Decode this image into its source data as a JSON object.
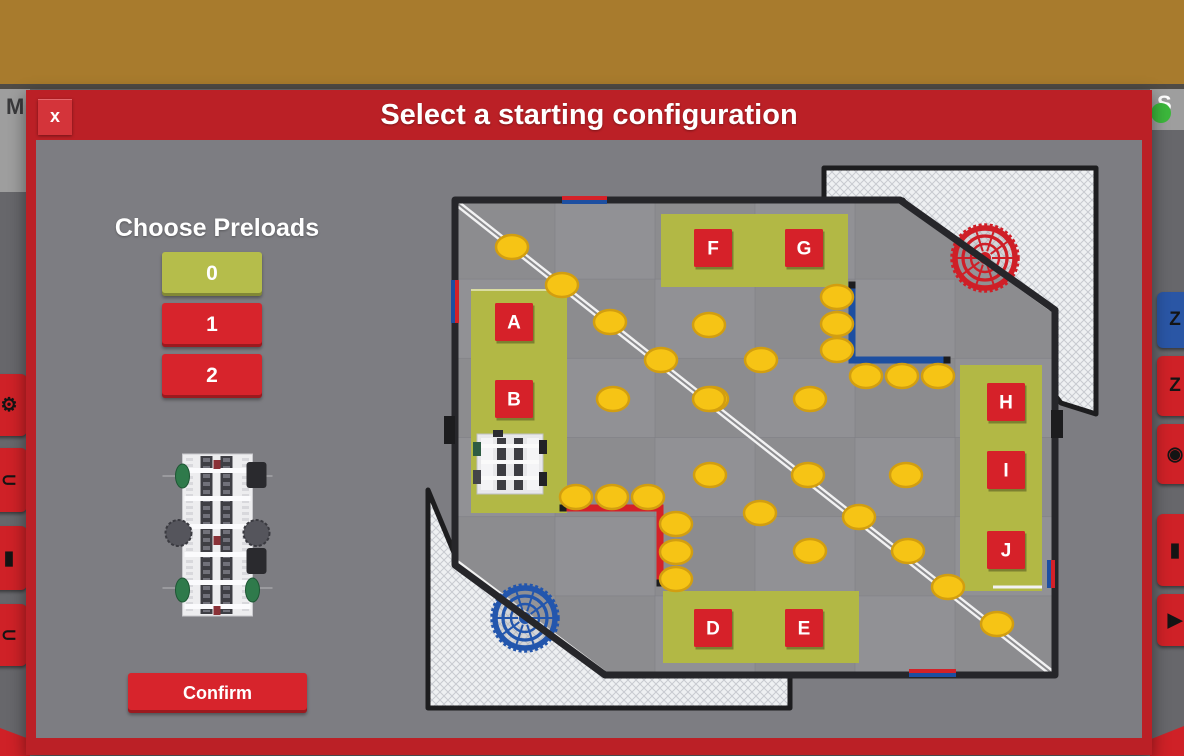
{
  "colors": {
    "topbar": "#a87b2d",
    "dialog_red": "#bb2026",
    "close_red": "#d4343a",
    "body_gray": "#7d7d82",
    "olive": "#b2b845",
    "button_red": "#d7242c",
    "button_olive": "#b5bd4b",
    "disc": "#f6c415",
    "disc_edge": "#d29e10",
    "tape_blue": "#1d4fa1",
    "tape_red": "#d42128",
    "goal_red": "#cf1f27",
    "goal_blue": "#2356ad",
    "mat_a": "#8c8c8f",
    "mat_b": "#95959a",
    "wall": "#26262a",
    "white_tape": "#f2f2f3",
    "green_dot": "#3cb83c"
  },
  "topbar": {
    "expand": "EXPAND",
    "hide": "HIDE",
    "activities": "ACTIVITIES",
    "close": "CLOSE"
  },
  "underlay": {
    "left_header": "M",
    "right_header": "S",
    "left_buttons": [
      {
        "name": "left-gear-button",
        "icon_name": "gear-icon",
        "icon": "⚙",
        "y": 374,
        "h": 62
      },
      {
        "name": "left-arc-button",
        "icon_name": "arc-icon",
        "icon": "⊂",
        "y": 448,
        "h": 64
      },
      {
        "name": "left-bar-button",
        "icon_name": "bar-icon",
        "icon": "▮",
        "y": 526,
        "h": 64
      },
      {
        "name": "left-arc2-button",
        "icon_name": "arc-icon",
        "icon": "⊂",
        "y": 604,
        "h": 62
      }
    ],
    "right_buttons": [
      {
        "name": "right-sleep-button",
        "icon_name": "z-icon",
        "icon": "Z",
        "color": "#2a56a5",
        "y": 292,
        "h": 56
      },
      {
        "name": "right-z-button",
        "icon_name": "z-icon",
        "icon": "Z",
        "color": "#cf2127",
        "y": 356,
        "h": 60
      },
      {
        "name": "right-eye-button",
        "icon_name": "eye-icon",
        "icon": "◉",
        "color": "#cf2127",
        "y": 424,
        "h": 60
      },
      {
        "name": "right-tool-button",
        "icon_name": "tool-icon",
        "icon": "▮",
        "color": "#cf2127",
        "y": 514,
        "h": 72
      },
      {
        "name": "right-play-button",
        "icon_name": "triangle-icon",
        "icon": "▶",
        "color": "#cf2127",
        "y": 594,
        "h": 52
      }
    ]
  },
  "dialog": {
    "title": "Select a starting configuration",
    "close_label": "x",
    "preloads_heading": "Choose Preloads",
    "preload_options": [
      {
        "label": "0",
        "selected": true
      },
      {
        "label": "1",
        "selected": false
      },
      {
        "label": "2",
        "selected": false
      }
    ],
    "confirm_label": "Confirm"
  },
  "field": {
    "wall_points": "35,40 480,40 635,150 635,515 185,515 35,405",
    "nets": [
      "404,8 676,8 676,254 641,243 483,40 404,40",
      "8,330 35,395 185,512 370,512 370,548 8,548"
    ],
    "zones": [
      {
        "x": 51,
        "y": 129,
        "w": 96,
        "h": 224
      },
      {
        "x": 241,
        "y": 54,
        "w": 187,
        "h": 73
      },
      {
        "x": 540,
        "y": 205,
        "w": 82,
        "h": 226
      },
      {
        "x": 243,
        "y": 431,
        "w": 196,
        "h": 72
      }
    ],
    "labels": [
      {
        "t": "A",
        "x": 94,
        "y": 162
      },
      {
        "t": "B",
        "x": 94,
        "y": 239
      },
      {
        "t": "F",
        "x": 293,
        "y": 88
      },
      {
        "t": "G",
        "x": 384,
        "y": 88
      },
      {
        "t": "H",
        "x": 586,
        "y": 242
      },
      {
        "t": "I",
        "x": 586,
        "y": 310
      },
      {
        "t": "J",
        "x": 586,
        "y": 390
      },
      {
        "t": "D",
        "x": 293,
        "y": 468
      },
      {
        "t": "E",
        "x": 384,
        "y": 468
      }
    ],
    "diagonal": {
      "x1": 38,
      "y1": 44,
      "x2": 633,
      "y2": 514
    },
    "pipes": [
      {
        "x1": 483,
        "y1": 42,
        "x2": 630,
        "y2": 148
      },
      {
        "x1": 38,
        "y1": 403,
        "x2": 183,
        "y2": 512
      }
    ],
    "tapes": [
      {
        "color": "blue",
        "points": [
          [
            432,
            125
          ],
          [
            432,
            200
          ],
          [
            527,
            200
          ]
        ]
      },
      {
        "color": "red",
        "points": [
          [
            143,
            348
          ],
          [
            240,
            348
          ],
          [
            240,
            423
          ]
        ]
      }
    ],
    "wall_tapes": [
      {
        "x1": 142,
        "y1": 38,
        "x2": 187,
        "y2": 38,
        "c": "red"
      },
      {
        "x1": 142,
        "y1": 42,
        "x2": 187,
        "y2": 42,
        "c": "blue"
      },
      {
        "x1": 33,
        "y1": 120,
        "x2": 33,
        "y2": 163,
        "c": "blue"
      },
      {
        "x1": 37,
        "y1": 120,
        "x2": 37,
        "y2": 163,
        "c": "red"
      },
      {
        "x1": 629,
        "y1": 400,
        "x2": 629,
        "y2": 428,
        "c": "blue"
      },
      {
        "x1": 633,
        "y1": 400,
        "x2": 633,
        "y2": 428,
        "c": "red"
      },
      {
        "x1": 489,
        "y1": 511,
        "x2": 536,
        "y2": 511,
        "c": "red"
      },
      {
        "x1": 489,
        "y1": 515,
        "x2": 536,
        "y2": 515,
        "c": "blue"
      }
    ],
    "goals": [
      {
        "x": 565,
        "y": 98,
        "c": "red"
      },
      {
        "x": 105,
        "y": 458,
        "c": "blue"
      }
    ],
    "tabs": [
      [
        24,
        256,
        11,
        28
      ],
      [
        631,
        250,
        12,
        28
      ]
    ],
    "discs": [
      [
        92,
        87
      ],
      [
        142,
        125
      ],
      [
        190,
        162
      ],
      [
        241,
        200
      ],
      [
        292,
        239
      ],
      [
        388,
        315
      ],
      [
        439,
        357
      ],
      [
        488,
        391
      ],
      [
        528,
        427
      ],
      [
        577,
        464
      ],
      [
        417,
        137
      ],
      [
        417,
        164
      ],
      [
        417,
        190
      ],
      [
        446,
        216
      ],
      [
        482,
        216
      ],
      [
        518,
        216
      ],
      [
        289,
        165
      ],
      [
        341,
        200
      ],
      [
        193,
        239
      ],
      [
        289,
        239
      ],
      [
        390,
        239
      ],
      [
        290,
        315
      ],
      [
        486,
        315
      ],
      [
        340,
        353
      ],
      [
        390,
        391
      ],
      [
        156,
        337
      ],
      [
        192,
        337
      ],
      [
        228,
        337
      ],
      [
        256,
        364
      ],
      [
        256,
        392
      ],
      [
        256,
        419
      ]
    ],
    "robot": {
      "x": 53,
      "y": 270
    }
  }
}
